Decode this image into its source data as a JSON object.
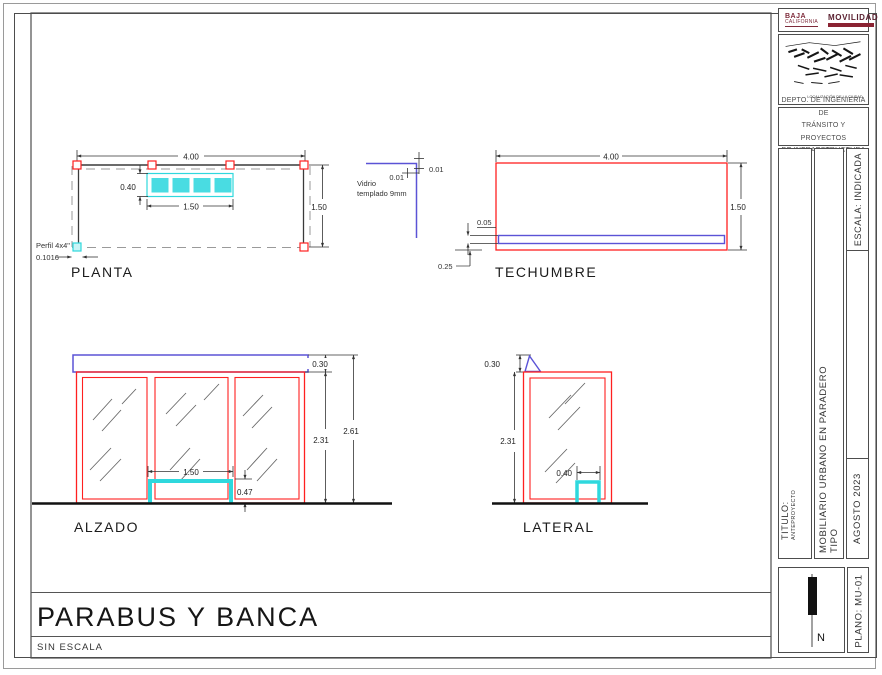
{
  "sheet": {
    "title": "PARABUS Y BANCA",
    "scale_note": "SIN ESCALA"
  },
  "titleblock": {
    "logo": {
      "brand_line1": "BAJA",
      "brand_line2": "CALIFORNIA",
      "agency": "MOVILIDAD"
    },
    "map_caption": "LOCALIZACIÓN DE LA CIUDAD",
    "department_lines": [
      "DEPTO. DE INGENIERIA DE",
      "TRÁNSITO Y PROYECTOS",
      "DE INFRAESTRUCTURA"
    ],
    "scale": "ESCALA: INDICADA",
    "title_label": "TITULO:",
    "title_value": "ANTEPROYECTO",
    "project": "MOBILIARIO URBANO EN PARADERO TIPO",
    "date": "AGOSTO 2023",
    "sheet_no": "PLANO: MU-01",
    "north_label": "N"
  },
  "views": {
    "planta": {
      "label": "PLANTA",
      "dim_width": "4.00",
      "dim_depth": "1.50",
      "bench_width": "1.50",
      "bench_depth": "0.40",
      "post_note": "Perfil 4x4\"",
      "post_size": "0.1016"
    },
    "glass_detail": {
      "note_line1": "Vidrio",
      "note_line2": "templado 9mm",
      "dim_a": "0.01",
      "dim_b": "0.01"
    },
    "techumbre": {
      "label": "TECHUMBRE",
      "dim_width": "4.00",
      "dim_depth": "1.50",
      "dim_fascia": "0.05",
      "dim_edge": "0.25"
    },
    "alzado": {
      "label": "ALZADO",
      "dim_roof": "0.30",
      "dim_body": "2.31",
      "dim_total": "2.61",
      "bench_width": "1.50",
      "bench_height": "0.47"
    },
    "lateral": {
      "label": "LATERAL",
      "dim_roof": "0.30",
      "dim_body": "2.31",
      "bench_depth": "0.40"
    }
  },
  "colors": {
    "structure_red": "#ff2020",
    "glass_blue": "#5b53d6",
    "bench_cyan": "#2fd8dd",
    "line_dark": "#333333",
    "dashed_gray": "#9a9a9a",
    "brand_maroon": "#7e2a3a"
  }
}
